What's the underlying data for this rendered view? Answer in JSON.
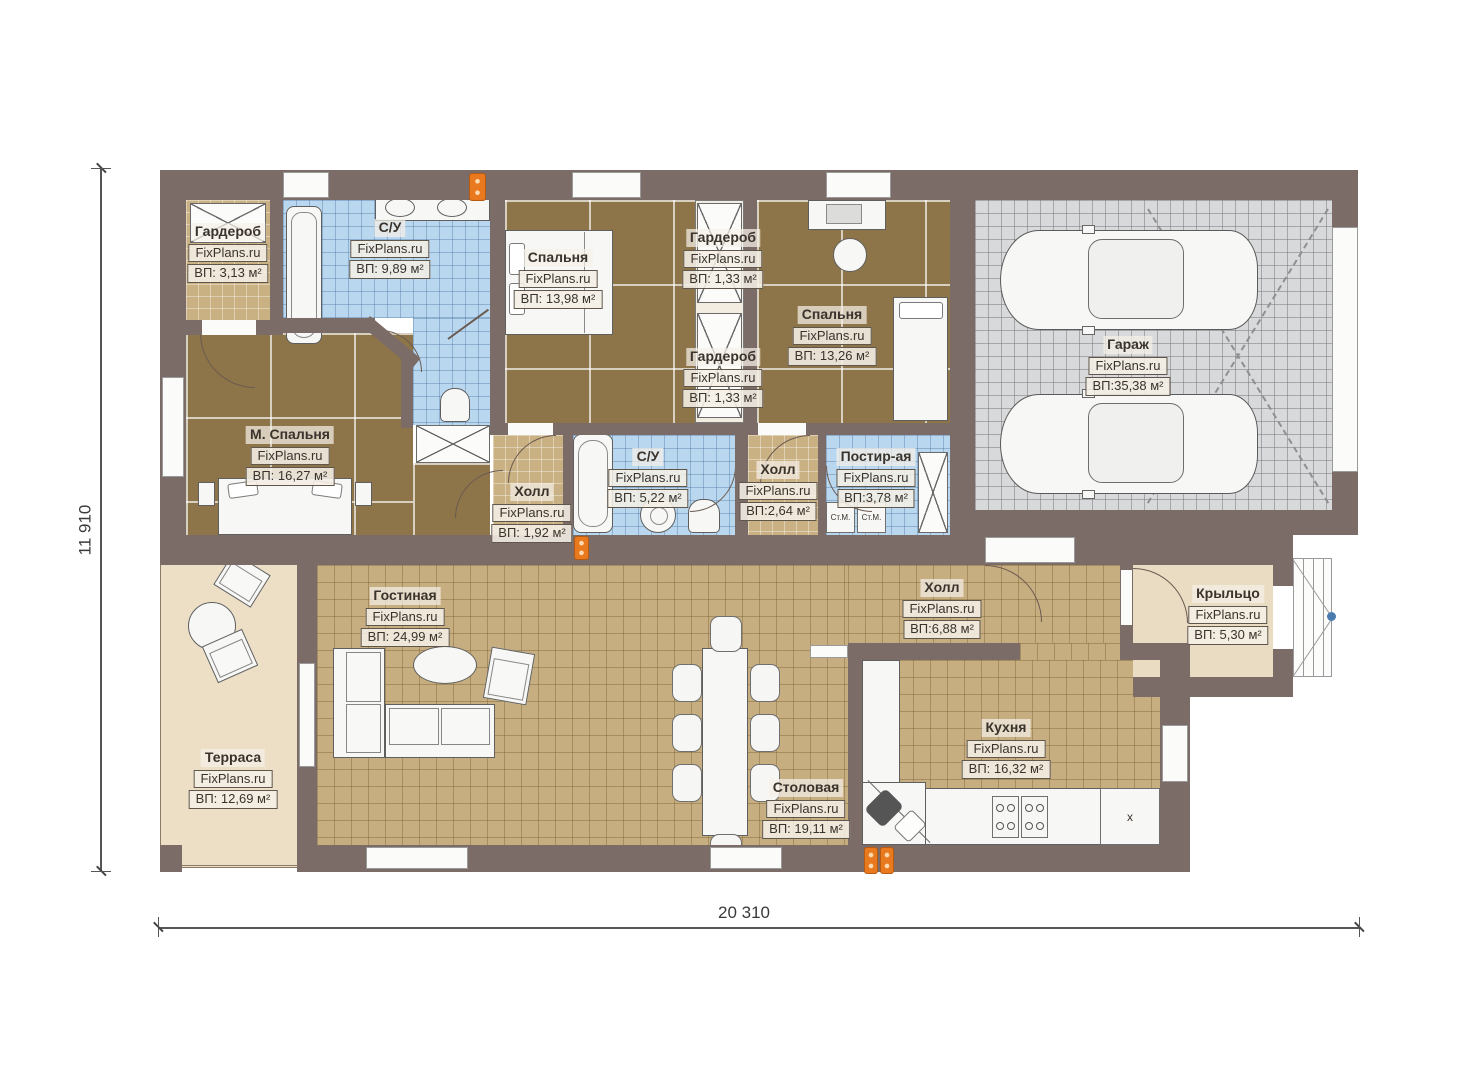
{
  "watermark": "FixPlans.ru",
  "dimensions": {
    "width": "20 310",
    "height": "11 910"
  },
  "appliances": {
    "washer": "Ст.М.",
    "cabinet": "x"
  },
  "colors": {
    "wall": "#7b6c68",
    "bathroom": "#b9d8f0",
    "bedroom": "#8d7549",
    "living": "#c7ae80",
    "garage": "#d8d9da",
    "terrace": "#ecdfc6",
    "accent": "#e8791e"
  },
  "rooms": [
    {
      "name": "Гардероб",
      "area": "ВП: 3,13 м²"
    },
    {
      "name": "С/У",
      "area": "ВП: 9,89 м²"
    },
    {
      "name": "Спальня",
      "area": "ВП: 13,98 м²"
    },
    {
      "name": "Гардероб",
      "area": "ВП: 1,33 м²"
    },
    {
      "name": "Гардероб",
      "area": "ВП: 1,33 м²"
    },
    {
      "name": "Спальня",
      "area": "ВП: 13,26 м²"
    },
    {
      "name": "Гараж",
      "area": "ВП:35,38 м²"
    },
    {
      "name": "М. Спальня",
      "area": "ВП: 16,27 м²"
    },
    {
      "name": "Холл",
      "area": "ВП: 1,92 м²"
    },
    {
      "name": "С/У",
      "area": "ВП: 5,22 м²"
    },
    {
      "name": "Холл",
      "area": "ВП:2,64 м²"
    },
    {
      "name": "Постир-ая",
      "area": "ВП:3,78 м²"
    },
    {
      "name": "Терраса",
      "area": "ВП: 12,69 м²"
    },
    {
      "name": "Гостиная",
      "area": "ВП: 24,99 м²"
    },
    {
      "name": "Холл",
      "area": "ВП:6,88 м²"
    },
    {
      "name": "Столовая",
      "area": "ВП: 19,11 м²"
    },
    {
      "name": "Кухня",
      "area": "ВП: 16,32 м²"
    },
    {
      "name": "Крыльцо",
      "area": "ВП: 5,30 м²"
    }
  ]
}
